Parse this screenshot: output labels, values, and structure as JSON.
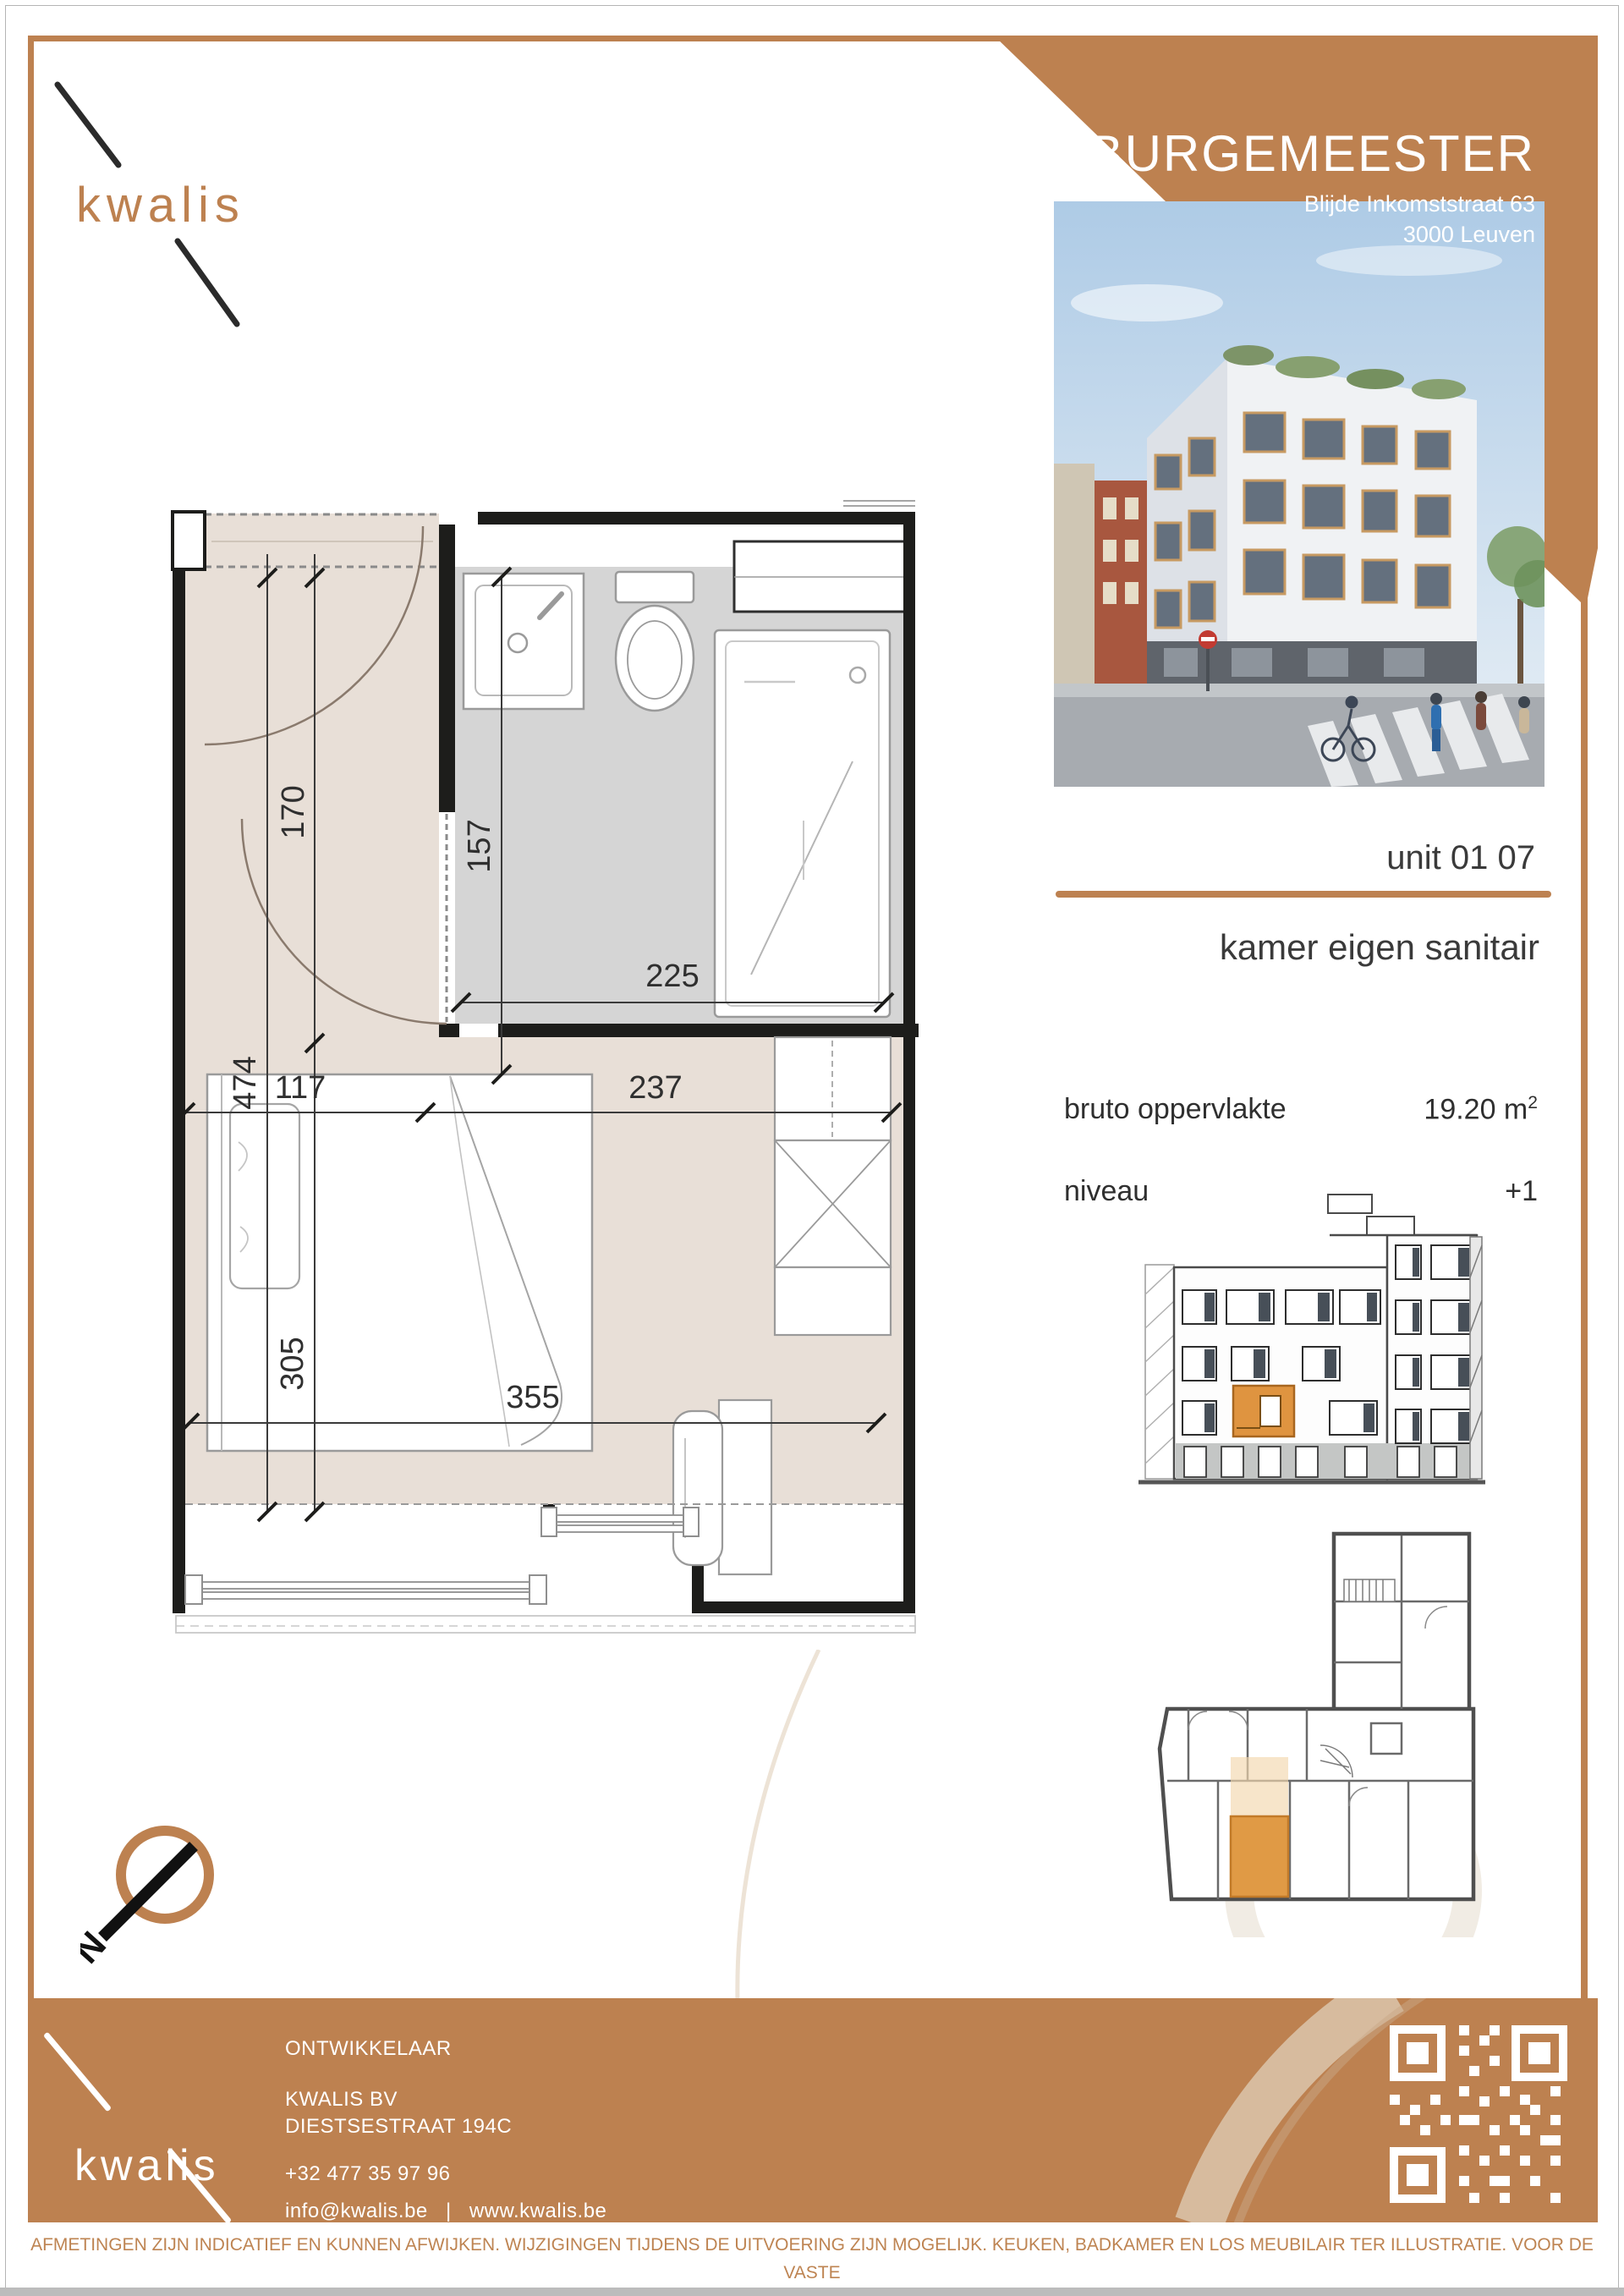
{
  "page": {
    "brand_orange": "#BD8150",
    "unit_highlight_orange": "#DF9440",
    "floor_beige": "#E8DFD7",
    "bath_gray": "#D5D5D5"
  },
  "header": {
    "logo_text": "kwalis",
    "title": "BURGEMEESTER",
    "address_line1": "Blijde Inkomststraat 63",
    "address_line2": "3000 Leuven"
  },
  "unit_panel": {
    "unit_label": "unit 01 07",
    "unit_type": "kamer eigen sanitair",
    "area_label": "bruto oppervlakte",
    "area_value": "19.20 m",
    "area_sup": "2",
    "level_label": "niveau",
    "level_value": "+1"
  },
  "plan": {
    "dims": {
      "d170": "170",
      "d157": "157",
      "d225": "225",
      "d117": "117",
      "d237": "237",
      "d474": "474",
      "d305": "305",
      "d355": "355"
    }
  },
  "compass": {
    "north_label": "N"
  },
  "footer": {
    "logo_text": "kwalis",
    "developer_label": "ONTWIKKELAAR",
    "company": "KWALIS BV",
    "street": "DIESTSESTRAAT 194C",
    "phone": "+32 477 35 97 96",
    "email": "info@kwalis.be",
    "separator": "|",
    "website": "www.kwalis.be"
  },
  "disclaimer": {
    "line1": "AFMETINGEN ZIJN INDICATIEF EN KUNNEN AFWIJKEN. WIJZIGINGEN TIJDENS DE UITVOERING ZIJN MOGELIJK. KEUKEN, BADKAMER EN LOS MEUBILAIR TER ILLUSTRATIE. VOOR DE VASTE",
    "line2": "INRICHTING GELDT DE BESCHRIJVING IN HET LASTENBOEK. ER KUNNEN GEEN RECHTEN AAN DIT PLAN ONTLEEND WORDEN."
  }
}
